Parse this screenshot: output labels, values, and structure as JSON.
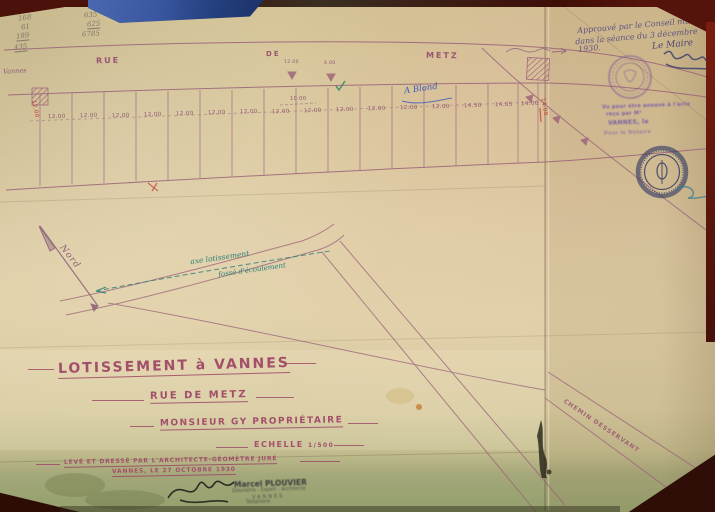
{
  "photo": {
    "background_color": "#441109",
    "paper_color": "#d7c499",
    "accent_ink": "#a34f6b",
    "teal_ink": "#2d8077",
    "blue_ink": "#3f58b8"
  },
  "pencil_calc": {
    "col1": [
      "168",
      "61",
      "189",
      "435"
    ],
    "col2": [
      "635",
      "625",
      "6785"
    ]
  },
  "approval": {
    "note_lines": [
      "Approuvé par le Conseil municipal",
      "dans la séance du 3 décembre",
      "1930."
    ],
    "signer_title": "Le Maire"
  },
  "vu_stamp": {
    "lines": [
      "Vu pour être annexé à l'acte",
      "reçu par Mᵉ",
      "VANNES, le",
      "Pour le Notaire"
    ]
  },
  "street": {
    "label_parts": [
      "RUE",
      "DE",
      "METZ"
    ],
    "left_direction": "Vannes"
  },
  "plots": {
    "dims": [
      "12.00",
      "12.00",
      "12.00",
      "12.00",
      "12.00",
      "12.00",
      "12.00",
      "12.00",
      "12.00",
      "12.00",
      "12.00",
      "12.00",
      "12.00",
      "14.50",
      "14.05",
      "14.00"
    ],
    "dim_upper_1": "12.00",
    "dim_upper_2": "4.00",
    "dim_inner": "10.00",
    "red_dim_left": "12.00",
    "red_dim_right": "14.00"
  },
  "annotations": {
    "blue_note": "A Blond",
    "teal_line1": "axe lotissement",
    "teal_line2": "fossé d'écoulement",
    "north_label": "Nord",
    "chemin_label": "CHEMIN DESSERVANT"
  },
  "title_block": {
    "line1": "LOTISSEMENT à VANNES",
    "line2": "RUE DE METZ",
    "line3": "MONSIEUR GY PROPRIÉTAIRE",
    "scale_label": "ECHELLE",
    "scale_value": "1/500"
  },
  "signature_block": {
    "line1": "LEVÉ ET DRESSÉ PAR L'ARCHITECTE-GÉOMÈTRE JURÉ",
    "line2": "VANNES, LE 27 OCTOBRE 1930",
    "stamp_name": "Marcel PLOUVIER",
    "stamp_lines": [
      "Géomètre - Expert - Architecte",
      "VANNES",
      "Téléphone"
    ]
  }
}
